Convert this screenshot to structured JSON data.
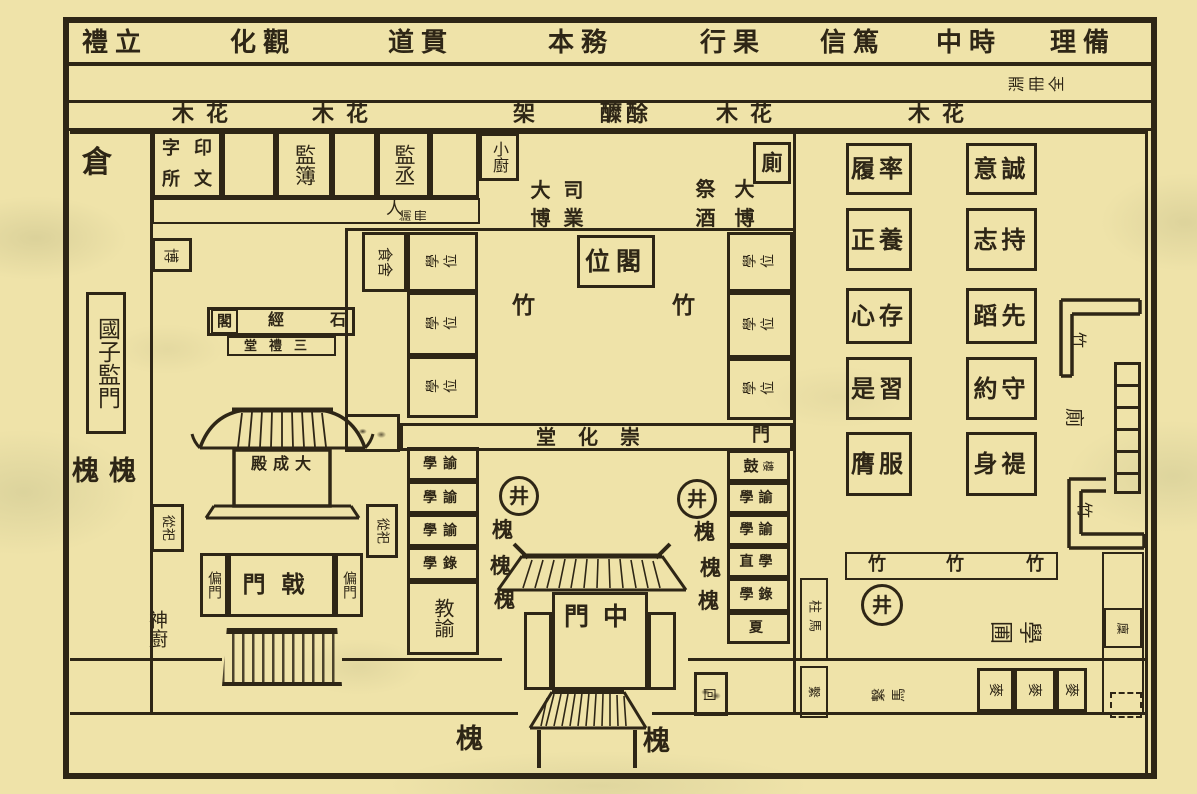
{
  "palette": {
    "paper": "#efe3a9",
    "ink": "#2e2616"
  },
  "maxims": [
    "禮立",
    "化觀",
    "道貫",
    "本務",
    "行果",
    "信篤",
    "中時",
    "理備"
  ],
  "maxims_note": "淵冊全",
  "flowers": [
    "木花",
    "木花",
    "架",
    "醾酴",
    "木花",
    "木花"
  ],
  "left_margin": {
    "granary": "倉",
    "main_gate": "國子監門",
    "trees": "槐槐",
    "spirit_kitchen": "神廚"
  },
  "offices": {
    "print": [
      "字",
      "印",
      "所",
      "文"
    ],
    "registrar": "監簿",
    "assistant": "監丞",
    "kitchen": "小廚",
    "privy": "廁",
    "corridor_figure": "人",
    "corridor_note": "諭冊",
    "director": [
      "大",
      "司",
      "博",
      "業"
    ],
    "chancellor": [
      "祭",
      "大",
      "酒",
      "博"
    ]
  },
  "courtyard": {
    "food_hall": "食舍",
    "room_label": "學位",
    "tablet_pavilion": "位閣",
    "hall": "堂化崇",
    "hall_door": "門"
  },
  "temple": {
    "tablet": "博",
    "stone_classics": [
      "閣",
      "經",
      "石"
    ],
    "three_rites": "堂禮三",
    "main_hall": "殿成大",
    "attendant": "從祀",
    "halberd_gate": "門戟",
    "side_gate": "偏門"
  },
  "staff_west": [
    "學諭",
    "學諭",
    "學諭",
    "學錄"
  ],
  "instructor": "教諭",
  "staff_east": {
    "drum": "鼓",
    "drum_small": "樓",
    "rows": [
      "學諭",
      "學諭",
      "直學",
      "學錄",
      "夏"
    ]
  },
  "well": "井",
  "tree": "槐",
  "bamboo": "竹",
  "middle_gate": "門中",
  "hitching": {
    "post_top": "柱馬",
    "post_bottom": "繫",
    "pair": "繫馬",
    "box": "回"
  },
  "garden_plot": "學圃",
  "shed": "麥",
  "granary_small": "廩",
  "east_privy": "廁",
  "studies_west": [
    "履率",
    "正養",
    "心存",
    "是習",
    "膺服"
  ],
  "studies_east": [
    "意誠",
    "志持",
    "蹈先",
    "約守",
    "身禔"
  ]
}
